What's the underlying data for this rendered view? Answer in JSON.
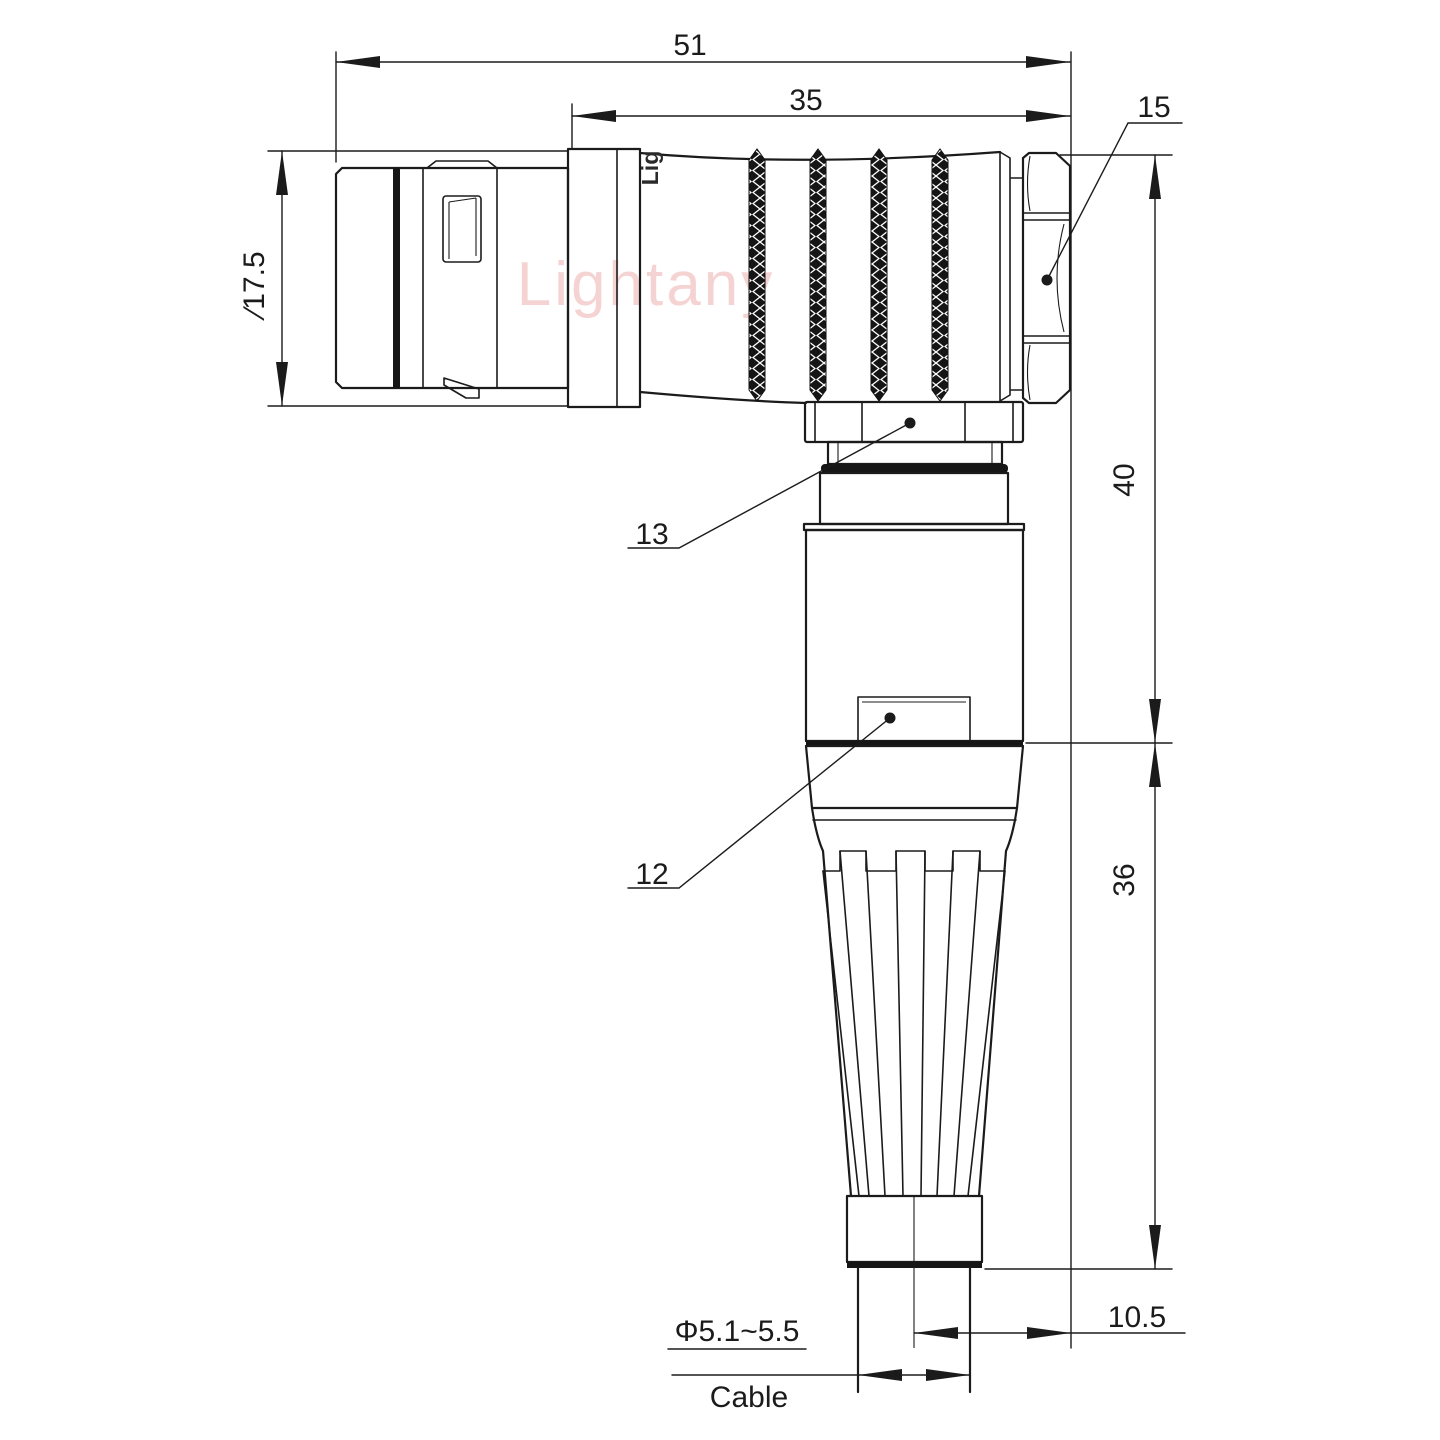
{
  "drawing": {
    "watermark": "Lightany",
    "engraving": "Lig",
    "dims": {
      "overall_length": "51",
      "body_length": "35",
      "nut_ref": "15",
      "plug_diameter": "∕17.5",
      "height_upper": "40",
      "height_boot": "36",
      "offset": "10.5",
      "cable_diameter": "Φ5.1~5.5",
      "cable_label": "Cable",
      "ref_13": "13",
      "ref_12": "12"
    },
    "colors": {
      "line": "#1b1b1b",
      "watermark": "#eda8a8"
    }
  }
}
